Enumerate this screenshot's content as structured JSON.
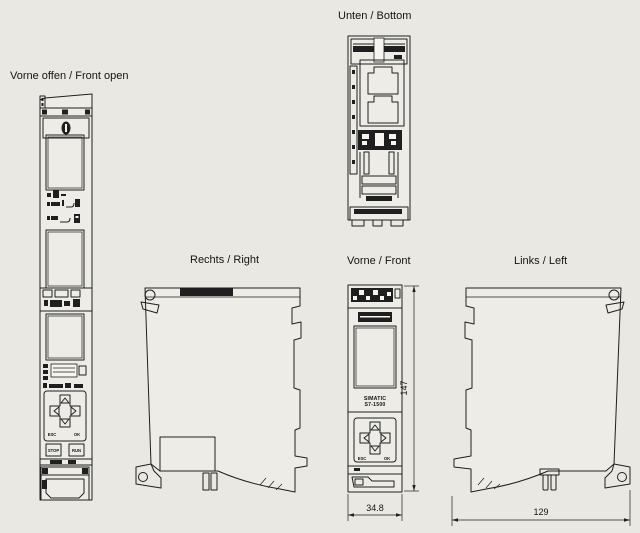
{
  "colors": {
    "background": "#e9e8e3",
    "ink": "#1f1f1f"
  },
  "labels": {
    "front_open": "Vorne offen / Front open",
    "bottom": "Unten / Bottom",
    "right": "Rechts / Right",
    "front": "Vorne / Front",
    "left": "Links / Left"
  },
  "front_view": {
    "brand_line1": "SIMATIC",
    "brand_line2": "S7-1500"
  },
  "keypad": {
    "esc": "ESC",
    "ok": "OK",
    "stop": "STOP",
    "run": "RUN"
  },
  "dimensions": {
    "height": "147",
    "width": "34.8",
    "depth": "129"
  }
}
